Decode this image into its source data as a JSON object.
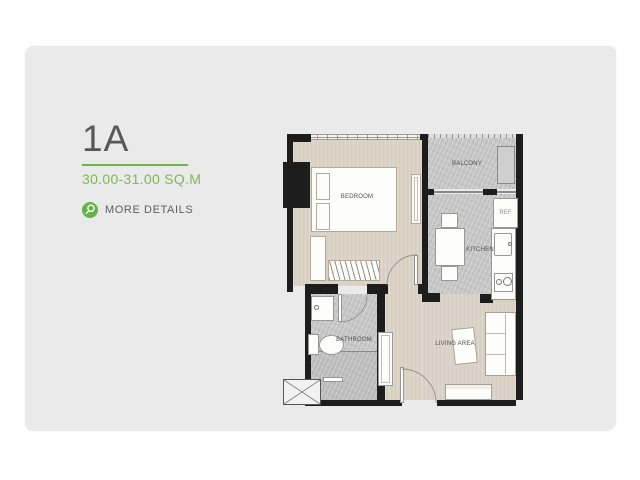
{
  "unit": {
    "label": "1A",
    "area": "30.00-31.00 SQ.M",
    "more_details": "MORE DETAILS"
  },
  "floorplan": {
    "labels": {
      "bedroom": "BEDROOM",
      "balcony": "BALCONY",
      "kitchen": "KITCHEN",
      "bathroom": "BATHROOM",
      "living": "LIVING AREA",
      "ref": "REF"
    }
  },
  "colors": {
    "accent_green": "#6fb649",
    "badge_green": "#66b348",
    "title_gray": "#58585a",
    "card_bg": "#eaeaea",
    "wall_black": "#1d1d1d",
    "floor_beige": "#d8d1c3",
    "floor_gray": "#c6c6c6"
  },
  "icons": {
    "magnifier": "search-icon"
  }
}
